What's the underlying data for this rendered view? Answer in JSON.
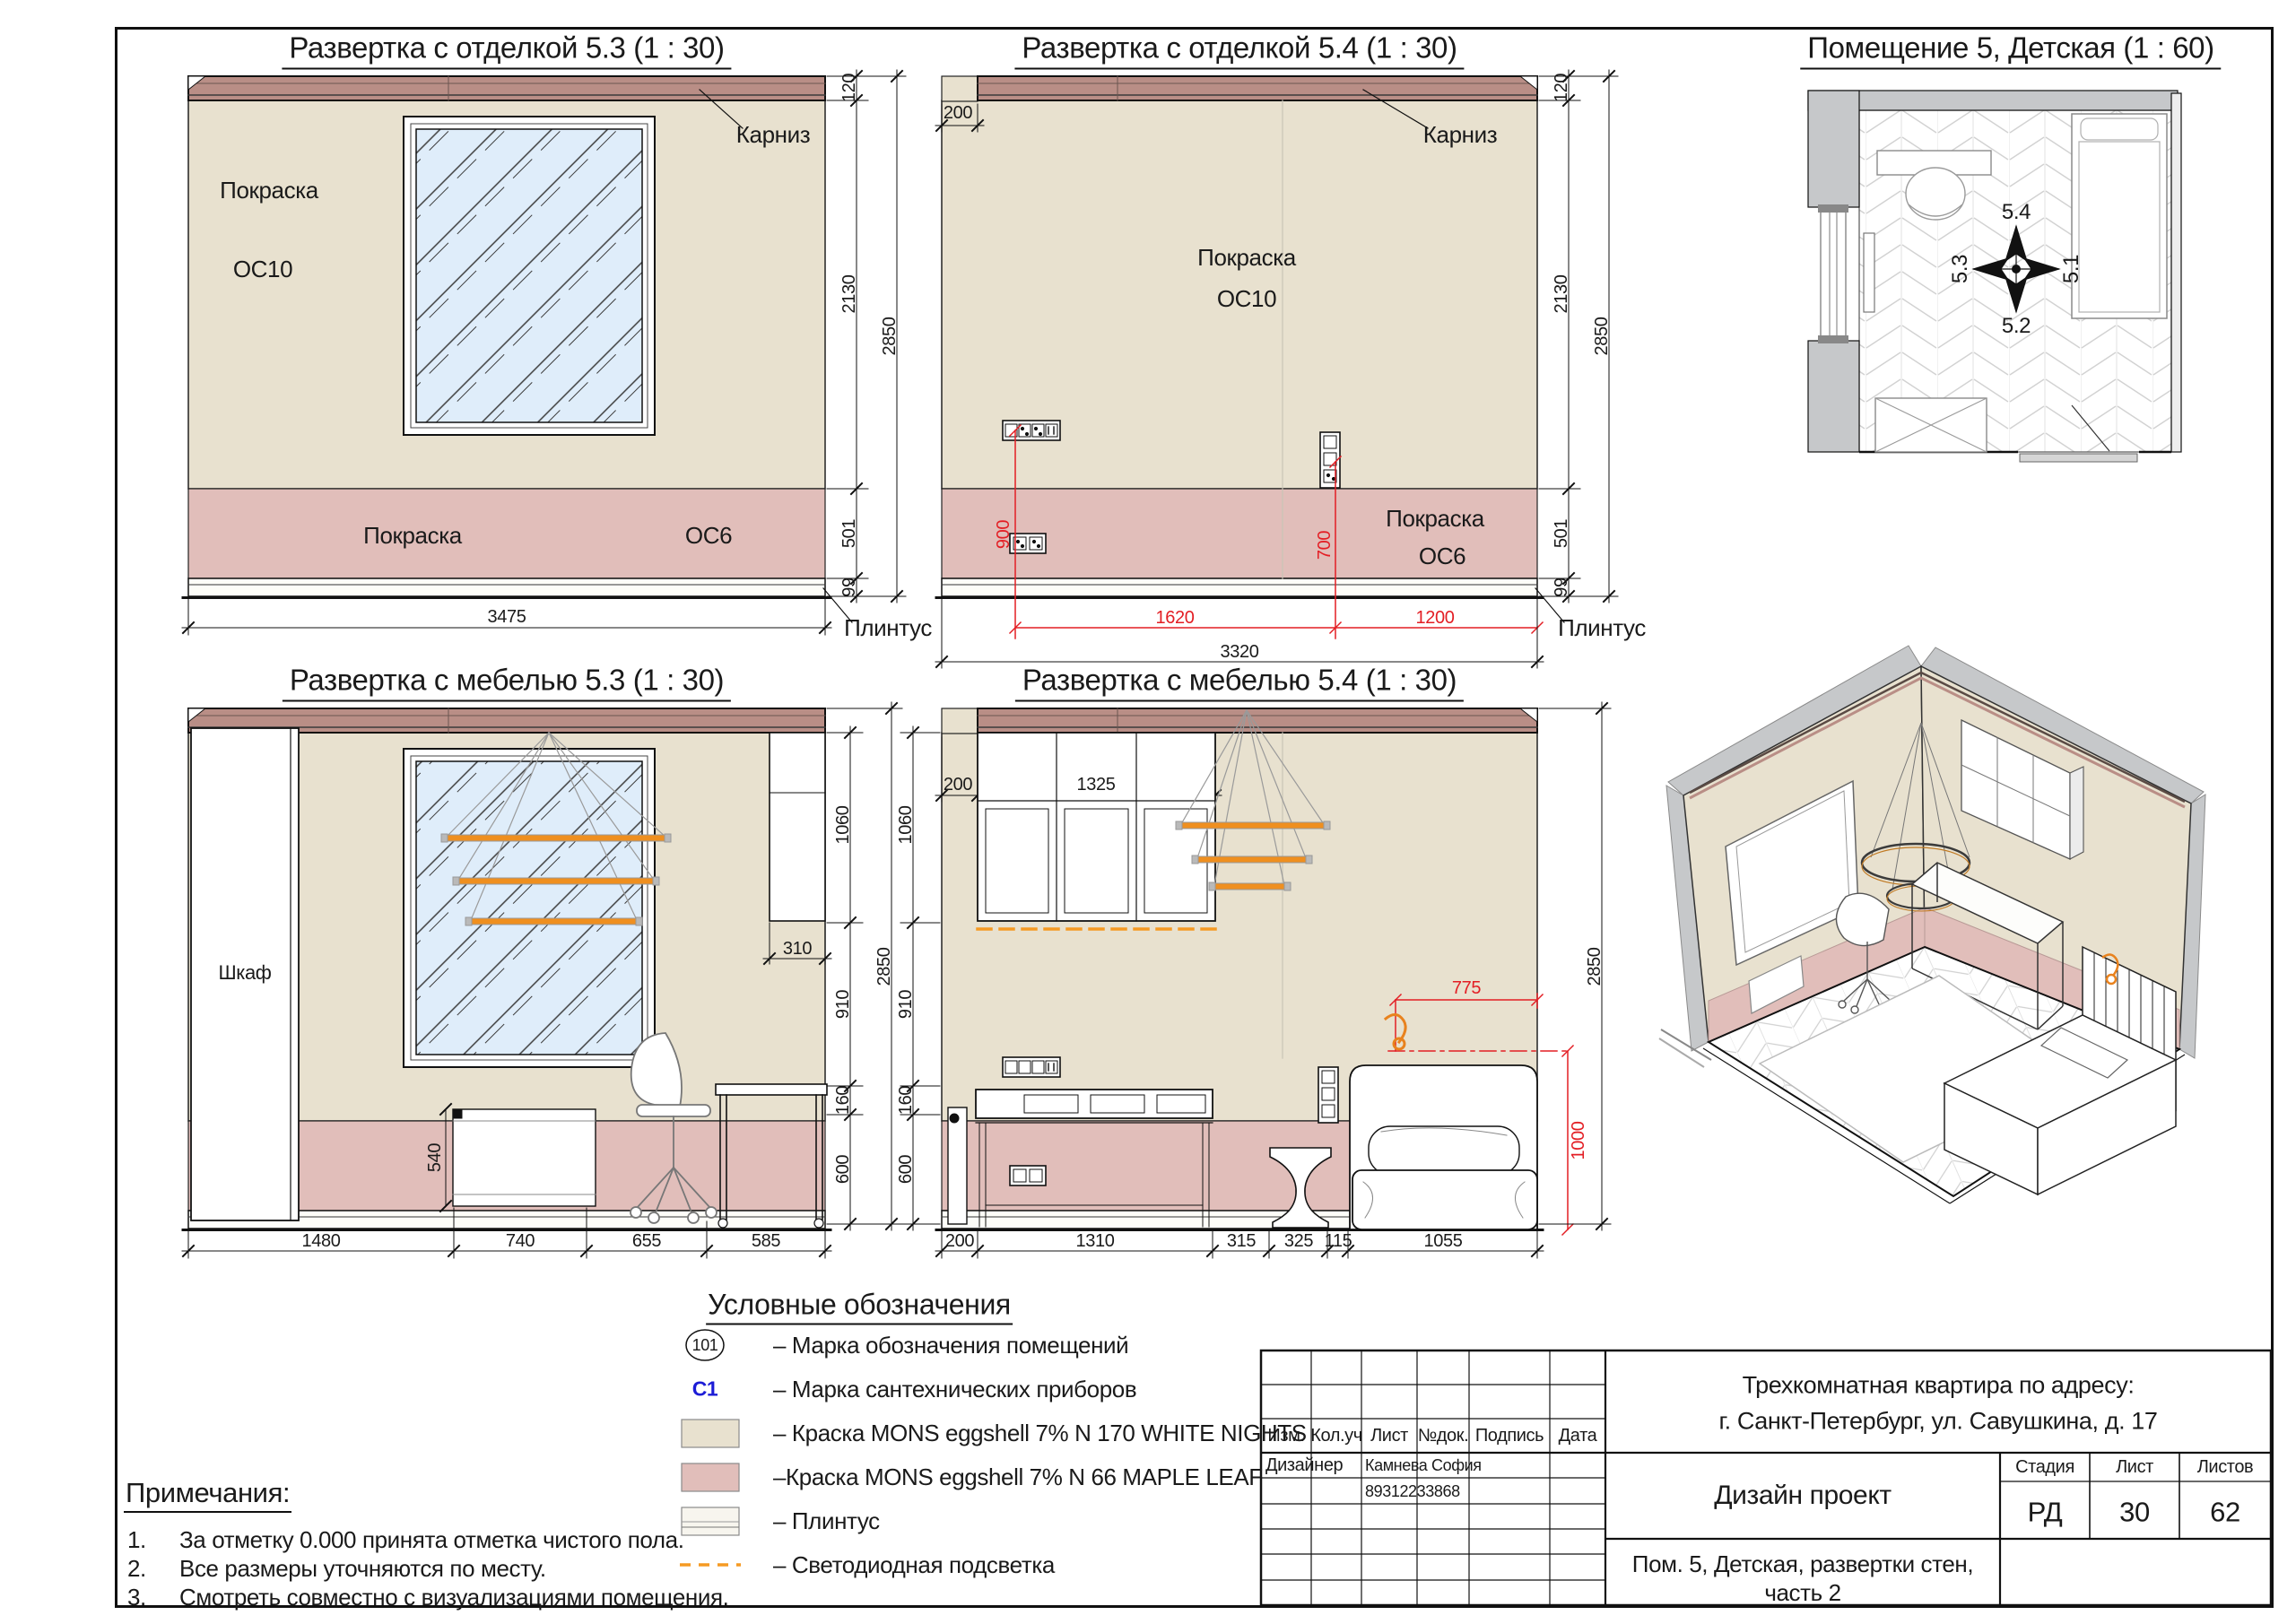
{
  "colors": {
    "beige": "#E8E1CF",
    "pink": "#E1BEBA",
    "cornice": "#B98E86",
    "glass": "#DFEDFA",
    "red": "#E31E24",
    "orange": "#F59A23",
    "blue": "#1C1CD6",
    "wall_gray": "#C6C8CA"
  },
  "titles": {
    "e53f": "Развертка с отделкой 5.3 (1 : 30)",
    "e54f": "Развертка с отделкой 5.4 (1 : 30)",
    "plan": "Помещение 5, Детская (1 : 60)",
    "e53m": "Развертка с мебелью 5.3 (1 : 30)",
    "e54m": "Развертка с мебелью 5.4 (1 : 30)",
    "legend": "Условные обозначения",
    "notes": "Примечания:"
  },
  "labels": {
    "pokraska": "Покраска",
    "os10": "ОС10",
    "os6": "ОС6",
    "karniz": "Карниз",
    "plintus": "Плинтус",
    "shkaf": "Шкаф"
  },
  "e53f": {
    "d120": "120",
    "d2130": "2130",
    "d2850": "2850",
    "d501": "501",
    "d99": "99",
    "width": "3475"
  },
  "e54f": {
    "n200": "200",
    "d120": "120",
    "d2130": "2130",
    "d2850": "2850",
    "d501": "501",
    "d99": "99",
    "width": "3320",
    "r900": "900",
    "r700": "700",
    "r1620": "1620",
    "r1200": "1200"
  },
  "plan": {
    "n54": "5.4",
    "n53": "5.3",
    "n51": "5.1",
    "n52": "5.2"
  },
  "e53m": {
    "d1060": "1060",
    "d310": "310",
    "d2850": "2850",
    "d910": "910",
    "d160": "160",
    "d600": "600",
    "d540": "540",
    "b1": "1480",
    "b2": "740",
    "b3": "655",
    "b4": "585"
  },
  "e54m": {
    "n200": "200",
    "d1325": "1325",
    "l1060": "1060",
    "l910": "910",
    "l160": "160",
    "l600": "600",
    "r2850": "2850",
    "r775": "775",
    "r1000": "1000",
    "b0": "200",
    "b1": "1310",
    "b2": "315",
    "b3": "325",
    "b4": "115",
    "b5": "1055"
  },
  "legend": {
    "items": [
      {
        "mark": "101",
        "label": "– Марка обозначения помещений"
      },
      {
        "mark": "С1",
        "label": "– Марка сантехнических приборов"
      },
      {
        "mark": "",
        "label": "– Краска MONS eggshell 7% N 170 WHITE NIGHTS"
      },
      {
        "mark": "",
        "label": "–Краска MONS eggshell 7% N 66 MAPLE LEAF"
      },
      {
        "mark": "",
        "label": "– Плинтус"
      },
      {
        "mark": "",
        "label": "– Светодиодная подсветка"
      }
    ]
  },
  "notes": {
    "nums": [
      "1.",
      "2.",
      "3."
    ],
    "items": [
      "За отметку 0.000 принята отметка чистого пола.",
      "Все размеры уточняются по месту.",
      "Смотреть совместно с визуализациями помещения."
    ]
  },
  "stamp": {
    "cols": [
      "Изм.",
      "Кол.уч",
      "Лист",
      "№док.",
      "Подпись",
      "Дата"
    ],
    "designer_label": "Дизайнер",
    "designer_name": "Камнева София",
    "designer_phone": "89312233868",
    "address1": "Трехкомнатная квартира по адресу:",
    "address2": "г. Санкт-Петербург, ул. Савушкина, д. 17",
    "project": "Дизайн проект",
    "stage_label": "Стадия",
    "sheet_label": "Лист",
    "sheets_label": "Листов",
    "stage": "РД",
    "sheet": "30",
    "sheets": "62",
    "object1": "Пом. 5, Детская, развертки стен,",
    "object2": "часть 2"
  }
}
